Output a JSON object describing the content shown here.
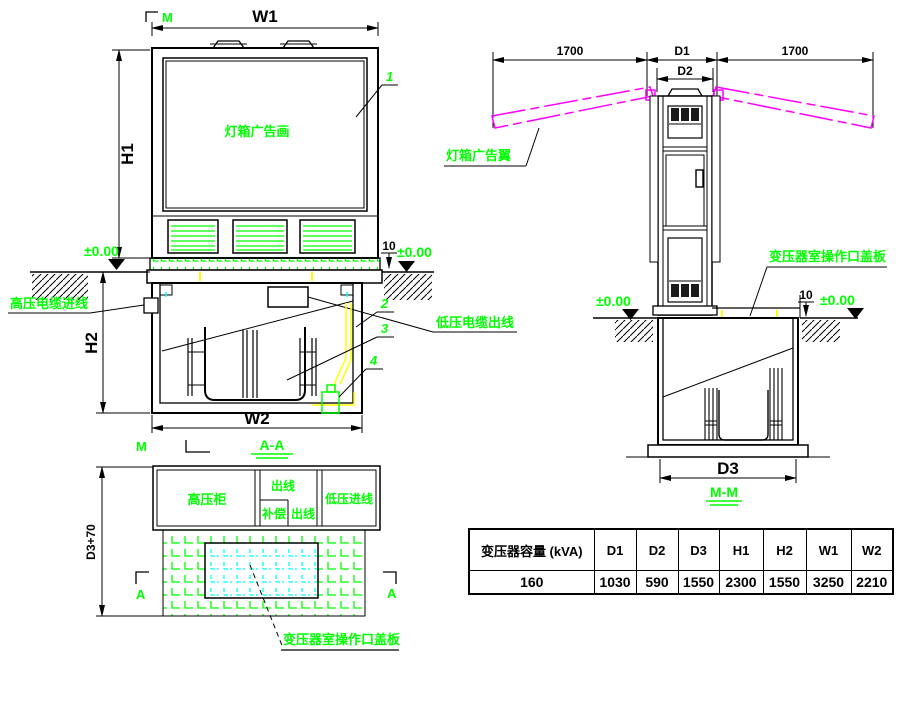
{
  "colors": {
    "annotation_green": "#00ff00",
    "wing_magenta": "#ff00ff",
    "cover_cyan": "#00ffff",
    "cable_yellow": "#ffff00",
    "line_black": "#000000",
    "background": "#ffffff"
  },
  "front_view": {
    "section_mark": "M",
    "w1": "W1",
    "h1": "H1",
    "panel_label": "灯箱广告画",
    "callout_1": "1",
    "level": "±0.00",
    "offset_10": "10"
  },
  "section_aa": {
    "h2": "H2",
    "w2": "W2",
    "hv_cable_in": "高压电缆进线",
    "lv_cable_out": "低压电缆出线",
    "callout_2": "2",
    "callout_3": "3",
    "callout_4": "4",
    "section_mark": "M",
    "title": "A-A"
  },
  "plan_view": {
    "dim_left": "D3+70",
    "hv_cabinet": "高压柜",
    "outgoing_top": "出线",
    "compensation": "补偿",
    "outgoing_bottom": "出线",
    "lv_incoming": "低压进线",
    "cover_label": "变压器室操作口盖板",
    "section_mark_left": "A",
    "section_mark_right": "A"
  },
  "side_view": {
    "span_left": "1700",
    "d1": "D1",
    "span_right": "1700",
    "d2": "D2",
    "wing_label": "灯箱广告翼",
    "cover_label": "变压器室操作口盖板",
    "offset_10": "10",
    "level": "±0.00",
    "d3": "D3",
    "title": "M-M"
  },
  "table": {
    "headers": [
      "变压器容量 (kVA)",
      "D1",
      "D2",
      "D3",
      "H1",
      "H2",
      "W1",
      "W2"
    ],
    "row": [
      "160",
      "1030",
      "590",
      "1550",
      "2300",
      "1550",
      "3250",
      "2210"
    ]
  }
}
